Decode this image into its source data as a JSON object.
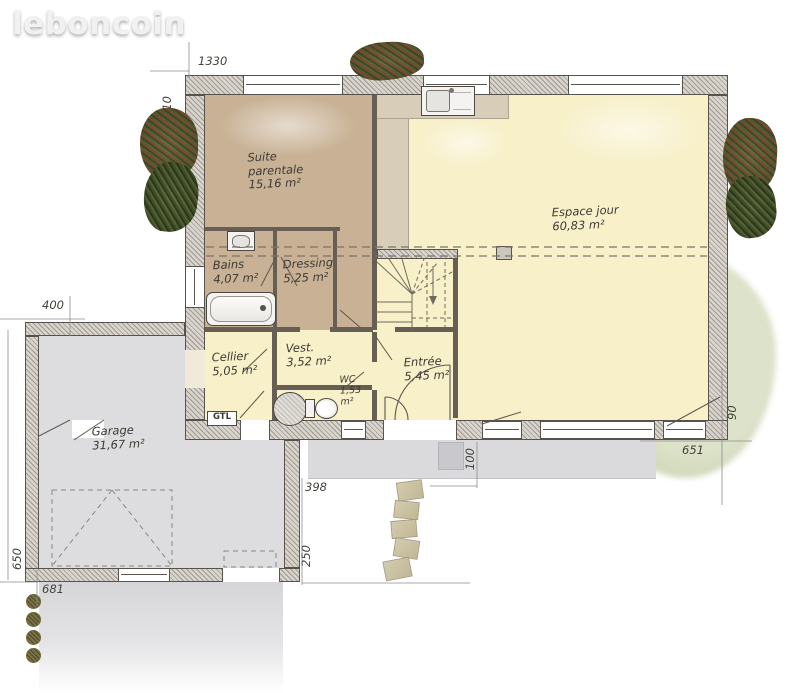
{
  "logo": {
    "text": "leboncoin"
  },
  "rooms": [
    {
      "key": "suite-parentale",
      "name": "Suite parentale",
      "area": "15,16 m²"
    },
    {
      "key": "espace-jour",
      "name": "Espace jour",
      "area": "60,83 m²"
    },
    {
      "key": "bains",
      "name": "Bains",
      "area": "4,07 m²"
    },
    {
      "key": "dressing",
      "name": "Dressing",
      "area": "5,25 m²"
    },
    {
      "key": "cellier",
      "name": "Cellier",
      "area": "5,05 m²"
    },
    {
      "key": "vestibule",
      "name": "Vest.",
      "area": "3,52 m²"
    },
    {
      "key": "wc",
      "name": "WC",
      "area": "1,53 m²"
    },
    {
      "key": "entree",
      "name": "Entrée",
      "area": "5,45 m²"
    },
    {
      "key": "garage",
      "name": "Garage",
      "area": "31,67 m²"
    }
  ],
  "dimensions": [
    {
      "id": "top-width",
      "value": "1330"
    },
    {
      "id": "left-height",
      "value": "610"
    },
    {
      "id": "garage-top-width",
      "value": "400"
    },
    {
      "id": "garage-left-height",
      "value": "650"
    },
    {
      "id": "garage-bottom-width",
      "value": "681"
    },
    {
      "id": "courtyard-width",
      "value": "398"
    },
    {
      "id": "courtyard-height",
      "value": "250"
    },
    {
      "id": "porch-depth",
      "value": "100"
    },
    {
      "id": "terrace-side",
      "value": "90"
    },
    {
      "id": "terrace-width",
      "value": "651"
    }
  ],
  "annotations": {
    "gtl": "GTL"
  },
  "icons": [
    "kitchen-sink",
    "washbasin",
    "bathtub",
    "water-heater",
    "toilet",
    "staircase",
    "car-space",
    "bush",
    "stepping-stones"
  ],
  "colors": {
    "suite_floor": "#c8b194",
    "kitchen_floor": "#d7cdb9",
    "living_floor": "#f7f0c9",
    "garage_floor": "#dddddf",
    "wall_line": "#57524b",
    "garden_green": "#d6dcc1",
    "label_ink": "#3d3a34"
  }
}
